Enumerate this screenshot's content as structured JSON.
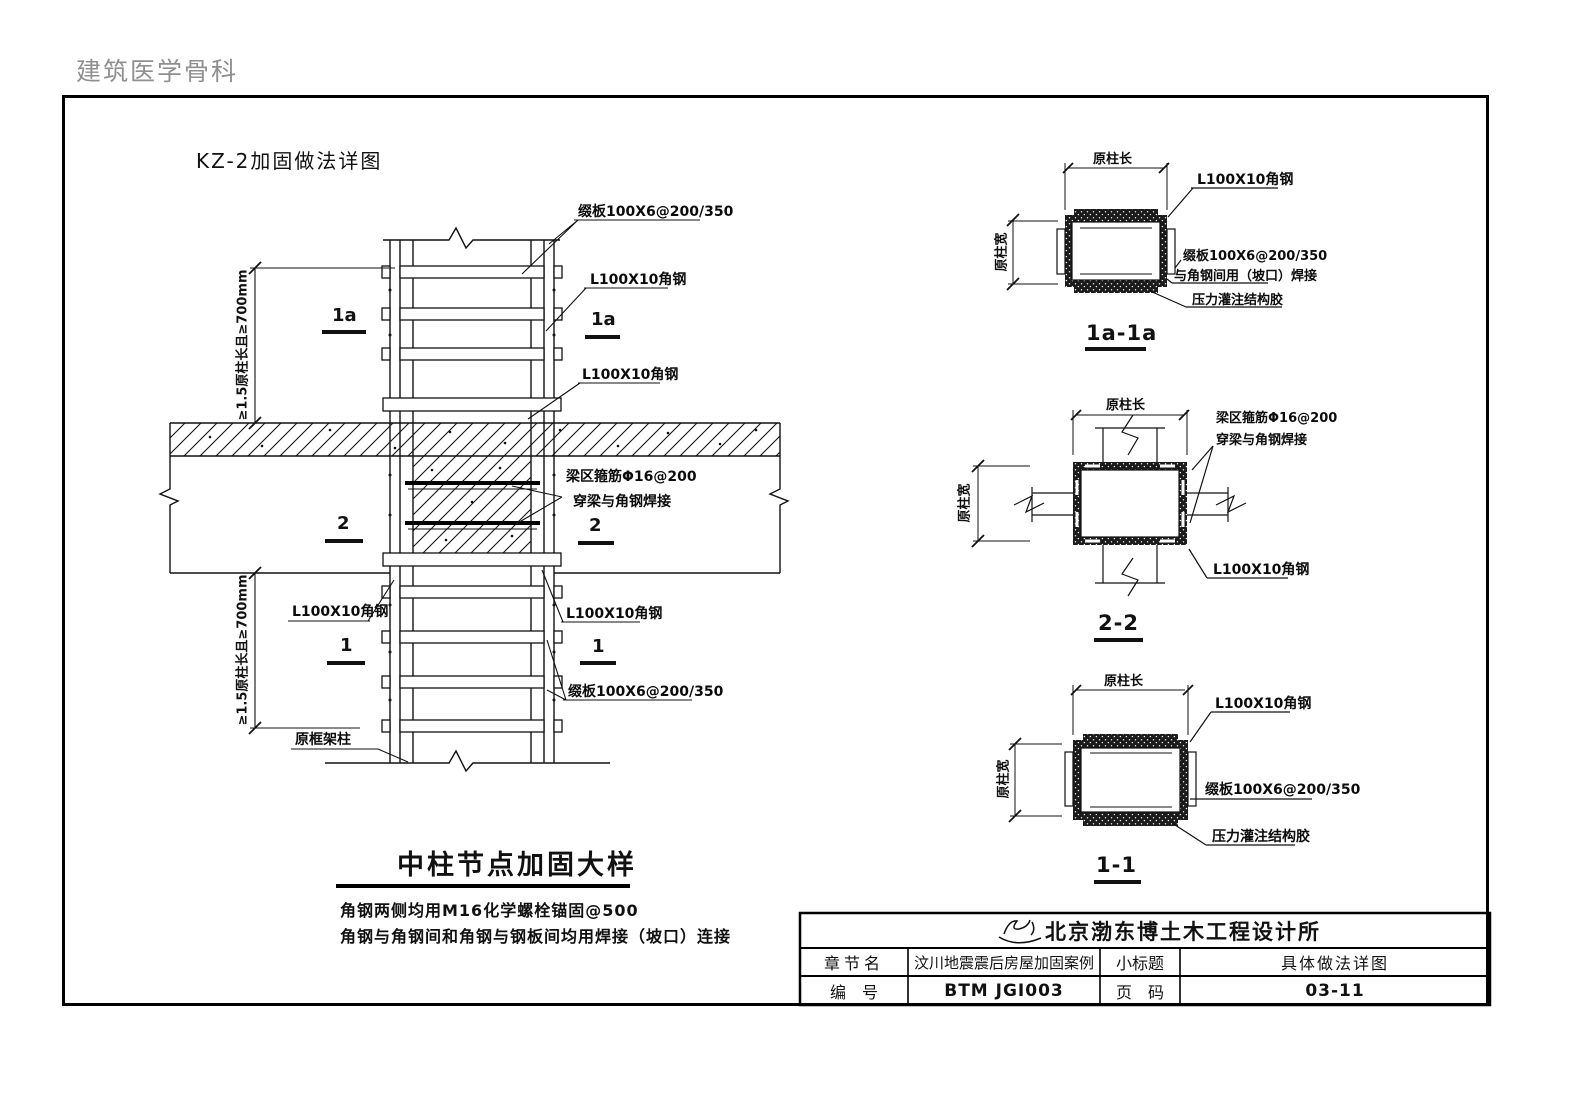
{
  "page": {
    "watermark": "建筑医学骨科",
    "sheet_title": "KZ-2加固做法详图"
  },
  "main_detail": {
    "caption": "中柱节点加固大样",
    "notes": [
      "角钢两侧均用M16化学螺栓锚固@500",
      "角钢与角钢间和角钢与钢板间均用焊接（坡口）连接"
    ],
    "dim_upper": "≥1.5原柱长且≥700mm",
    "dim_lower": "≥1.5原柱长且≥700mm",
    "labels": {
      "batten_top": "缀板100X6@200/350",
      "angle_top": "L100X10角钢",
      "angle_mid": "L100X10角钢",
      "beam_bar_line1": "梁区箍筋Φ16@200",
      "beam_bar_line2": "穿梁与角钢焊接",
      "angle_lower_left": "L100X10角钢",
      "angle_lower_right": "L100X10角钢",
      "batten_lower": "缀板100X6@200/350",
      "original_column": "原框架柱"
    },
    "marks": {
      "m1a_left": "1a",
      "m1a_right": "1a",
      "m2_left": "2",
      "m2_right": "2",
      "m1_left": "1",
      "m1_right": "1"
    }
  },
  "section_1a": {
    "title": "1a-1a",
    "dim_top": "原柱长",
    "dim_left": "原柱宽",
    "label_angle": "L100X10角钢",
    "label_batten": "缀板100X6@200/350",
    "label_weld": "与角钢间用（坡口）焊接",
    "label_glue": "压力灌注结构胶"
  },
  "section_22": {
    "title": "2-2",
    "dim_top": "原柱长",
    "dim_left": "原柱宽",
    "label_bar_line1": "梁区箍筋Φ16@200",
    "label_bar_line2": "穿梁与角钢焊接",
    "label_angle": "L100X10角钢"
  },
  "section_11": {
    "title": "1-1",
    "dim_top": "原柱长",
    "dim_left": "原柱宽",
    "label_angle": "L100X10角钢",
    "label_batten": "缀板100X6@200/350",
    "label_glue": "压力灌注结构胶"
  },
  "title_block": {
    "company": "北京渤东博土木工程设计所",
    "row1": {
      "label_a": "章节名",
      "value_a": "汶川地震震后房屋加固案例",
      "label_b": "小标题",
      "value_b": "具体做法详图"
    },
    "row2": {
      "label_a": "编　号",
      "value_a": "BTM JGI003",
      "label_b": "页　码",
      "value_b": "03-11"
    }
  }
}
